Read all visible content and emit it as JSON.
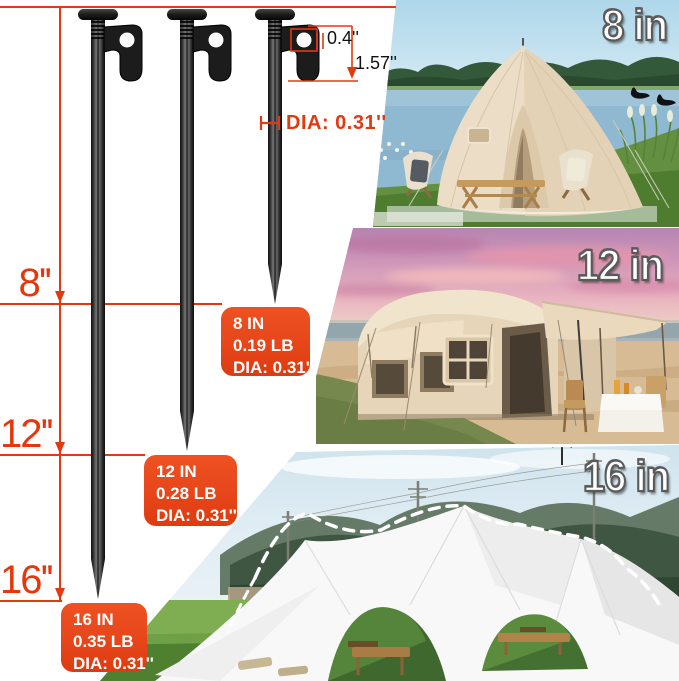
{
  "canvas": {
    "width": 679,
    "height": 681,
    "background": "#ffffff"
  },
  "colors": {
    "dimension_red": "#e23a10",
    "marker_red": "#e8360c",
    "spec_box_orange": "#e8481c",
    "spec_box_text": "#ffffff",
    "stake_black": "#161616"
  },
  "annotations": {
    "hook_hole_width": "0.4''",
    "hook_height": "1.57''",
    "shaft_diameter": "DIA: 0.31''"
  },
  "length_markers": [
    {
      "label": "8''"
    },
    {
      "label": "12''"
    },
    {
      "label": "16''"
    }
  ],
  "spec_boxes": [
    {
      "size": "8 IN",
      "weight": "0.19 LB",
      "diameter": "DIA: 0.31''"
    },
    {
      "size": "12 IN",
      "weight": "0.28 LB",
      "diameter": "DIA: 0.31''"
    },
    {
      "size": "16 IN",
      "weight": "0.35 LB",
      "diameter": "DIA: 0.31''"
    }
  ],
  "photos": [
    {
      "label": "8 in",
      "alt": "beige bell tent beside a lake with camp chairs and black swans"
    },
    {
      "label": "12 in",
      "alt": "large beige cabin tent on a beach under a pink sunset sky"
    },
    {
      "label": "16 in",
      "alt": "white star-shaped canopy staked on a green field below mountains"
    }
  ]
}
